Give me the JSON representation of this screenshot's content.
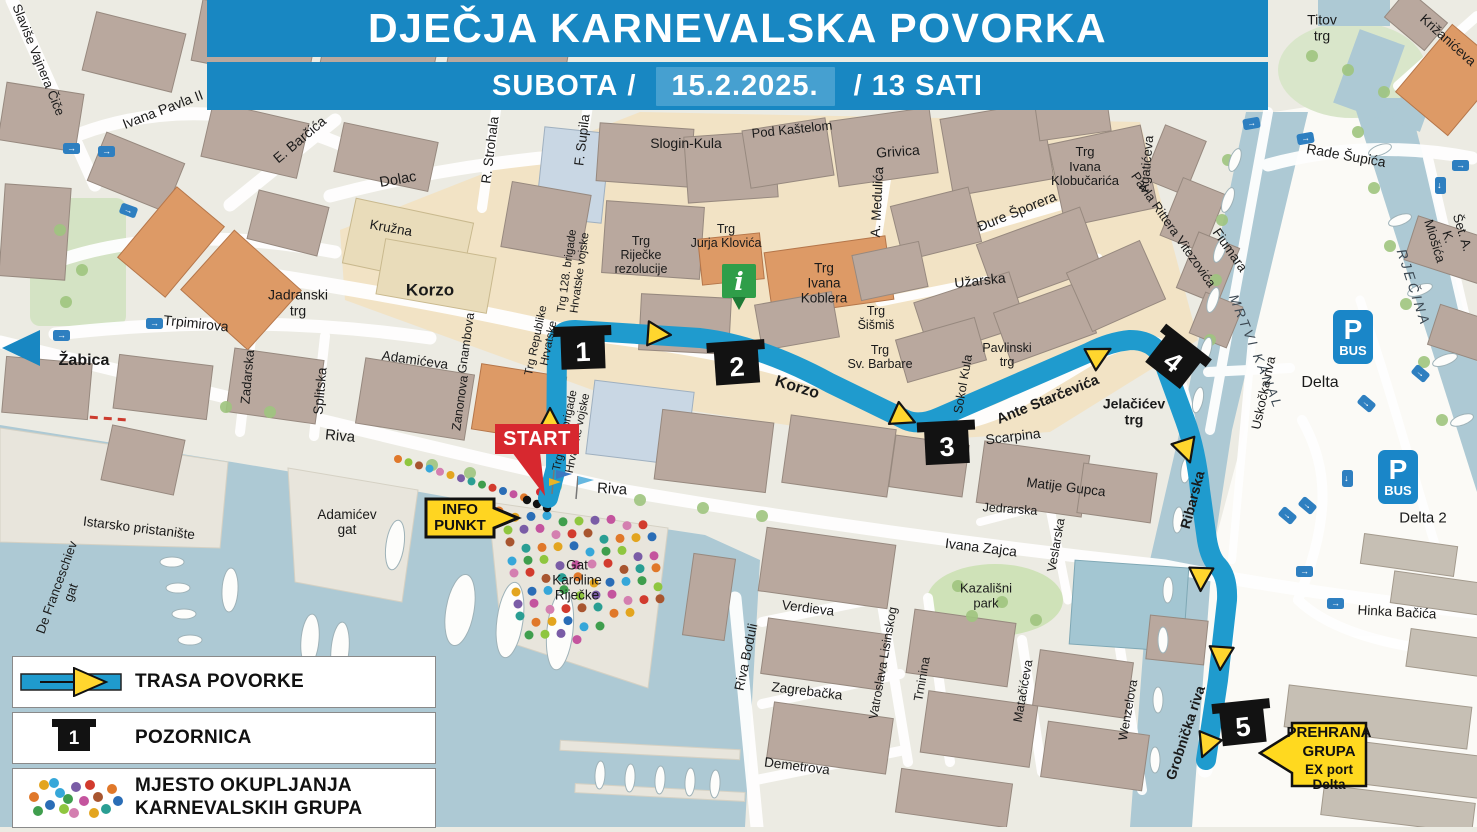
{
  "banner": {
    "title": "DJEČJA KARNEVALSKA POVORKA",
    "day": "SUBOTA",
    "separator1": "/",
    "date": "15.2.2025.",
    "separator2": "/",
    "time": "13 SATI"
  },
  "markers": {
    "start_label": "START",
    "info_punkt_line1": "INFO",
    "info_punkt_line2": "PUNKT",
    "info_icon": "i",
    "stages": [
      "1",
      "2",
      "3",
      "4",
      "5"
    ],
    "prehrana": {
      "line1": "PREHRANA",
      "line2": "GRUPA",
      "line3": "EX port Delta"
    }
  },
  "parking": {
    "p": "P",
    "bus": "BUS",
    "delta": "Delta",
    "delta2": "Delta 2"
  },
  "icons": {
    "one_way": "→"
  },
  "legend": {
    "items": [
      {
        "icon": "route-arrow",
        "label": "TRASA POVORKE"
      },
      {
        "icon": "stage-marker",
        "label": "POZORNICA"
      },
      {
        "icon": "colored-dots",
        "label": "MJESTO OKUPLJANJA KARNEVALSKIH GRUPA",
        "label_line1": "MJESTO OKUPLJANJA",
        "label_line2": "KARNEVALSKIH GRUPA"
      }
    ]
  },
  "colors": {
    "banner_blue": "#1887c2",
    "date_box_blue": "#46a0d0",
    "route_blue": "#1f9bce",
    "arrow_yellow": "#ffd62e",
    "stage_black": "#121212",
    "start_red": "#d7282f",
    "info_yellow": "#ffd521",
    "info_green": "#2f9e49",
    "pbus_blue": "#1a86c8",
    "water": "#adc9d4",
    "old_town_tan": "#f2e2c2",
    "building": "#b9a89e"
  },
  "map_labels": [
    {
      "t": "Slaviše Vajnera Čiče",
      "x": 38,
      "y": 60,
      "r": 68,
      "s": 13
    },
    {
      "t": "Ivana Pavla II",
      "x": 163,
      "y": 110,
      "r": -21,
      "s": 14
    },
    {
      "t": "E. Barčića",
      "x": 300,
      "y": 140,
      "r": -40,
      "s": 14
    },
    {
      "t": "Dolac",
      "x": 398,
      "y": 180,
      "r": -10,
      "s": 14.5
    },
    {
      "t": "R. Strohala",
      "x": 490,
      "y": 150,
      "r": -83,
      "s": 13.5
    },
    {
      "t": "F. Supila",
      "x": 582,
      "y": 140,
      "r": -83,
      "s": 13.5
    },
    {
      "t": "Slogin-Kula",
      "x": 686,
      "y": 144,
      "r": 0,
      "s": 14
    },
    {
      "t": "Pod Kaštelom",
      "x": 792,
      "y": 130,
      "r": -6,
      "s": 13
    },
    {
      "t": "Grivica",
      "x": 898,
      "y": 152,
      "r": -4,
      "s": 14
    },
    {
      "t": "A. Medulića",
      "x": 877,
      "y": 202,
      "r": -87,
      "s": 13.5
    },
    {
      "t": "Đure Šporera",
      "x": 1017,
      "y": 212,
      "r": -22,
      "s": 14
    },
    {
      "t": "Trg\nIvana\nKlobučarića",
      "x": 1085,
      "y": 167,
      "r": 0,
      "s": 13
    },
    {
      "t": "Titov\ntrg",
      "x": 1322,
      "y": 28,
      "r": 0,
      "s": 14
    },
    {
      "t": "Križanićeva",
      "x": 1448,
      "y": 40,
      "r": 42,
      "s": 13.5
    },
    {
      "t": "Rade Šupića",
      "x": 1346,
      "y": 156,
      "r": 10,
      "s": 14
    },
    {
      "t": "Šet. A. K. Miošića",
      "x": 1448,
      "y": 237,
      "r": 73,
      "s": 13
    },
    {
      "t": "RJEČINA",
      "x": 1413,
      "y": 288,
      "r": 72,
      "s": 14,
      "it": 1,
      "ls": 3,
      "c": "#3c4852"
    },
    {
      "t": "MRTVI  KANAL",
      "x": 1256,
      "y": 352,
      "r": 68,
      "s": 13.5,
      "it": 1,
      "ls": 3,
      "c": "#3c4852"
    },
    {
      "t": "Fiumara",
      "x": 1230,
      "y": 250,
      "r": 55,
      "s": 13.5
    },
    {
      "t": "Pavla Rittera Vitezovića",
      "x": 1173,
      "y": 230,
      "r": 55,
      "s": 13
    },
    {
      "t": "Agatićeva",
      "x": 1147,
      "y": 164,
      "r": -85,
      "s": 13
    },
    {
      "t": "Kružna",
      "x": 391,
      "y": 228,
      "r": 10,
      "s": 13.5
    },
    {
      "t": "Korzo",
      "x": 430,
      "y": 290,
      "r": 0,
      "s": 17,
      "w": 700
    },
    {
      "t": "Jadranski\ntrg",
      "x": 298,
      "y": 303,
      "r": 0,
      "s": 14
    },
    {
      "t": "Trpimirova",
      "x": 196,
      "y": 324,
      "r": 6,
      "s": 14
    },
    {
      "t": "Žabica",
      "x": 84,
      "y": 361,
      "r": 0,
      "s": 16,
      "w": 700
    },
    {
      "t": "Zadarska",
      "x": 248,
      "y": 377,
      "r": -85,
      "s": 13
    },
    {
      "t": "Splitska",
      "x": 320,
      "y": 391,
      "r": -85,
      "s": 13.5
    },
    {
      "t": "Adamićeva",
      "x": 415,
      "y": 360,
      "r": 8,
      "s": 13.5
    },
    {
      "t": "Gnambova",
      "x": 466,
      "y": 343,
      "r": -82,
      "s": 12.5
    },
    {
      "t": "Zanonova",
      "x": 460,
      "y": 403,
      "r": -82,
      "s": 12.5
    },
    {
      "t": "Trg Republike\nHrvatske",
      "x": 543,
      "y": 342,
      "r": -78,
      "s": 11.5
    },
    {
      "t": "Trg 111. brigade\nHrvatske vojske",
      "x": 572,
      "y": 432,
      "r": -78,
      "s": 11.5
    },
    {
      "t": "Trg 128. brigade\nHrvatske vojske",
      "x": 574,
      "y": 272,
      "r": -82,
      "s": 11.5
    },
    {
      "t": "Trg\nRiječke\nrezolucije",
      "x": 641,
      "y": 255,
      "r": 0,
      "s": 12.5
    },
    {
      "t": "Trg\nJurja Klovića",
      "x": 726,
      "y": 236,
      "r": 0,
      "s": 12.5
    },
    {
      "t": "Trg\nIvana\nKoblera",
      "x": 824,
      "y": 283,
      "r": 0,
      "s": 13.5
    },
    {
      "t": "Trg\nŠišmiš",
      "x": 876,
      "y": 318,
      "r": 0,
      "s": 12.5
    },
    {
      "t": "Trg\nSv. Barbare",
      "x": 880,
      "y": 357,
      "r": 0,
      "s": 12.5
    },
    {
      "t": "Pavlinski\ntrg",
      "x": 1007,
      "y": 355,
      "r": 0,
      "s": 12.5
    },
    {
      "t": "Užarska",
      "x": 980,
      "y": 281,
      "r": -6,
      "s": 14
    },
    {
      "t": "Sokol Kula",
      "x": 963,
      "y": 384,
      "r": -80,
      "s": 12.5
    },
    {
      "t": "Korzo",
      "x": 797,
      "y": 388,
      "r": 17,
      "s": 16,
      "w": 600
    },
    {
      "t": "Ante Starčevića",
      "x": 1048,
      "y": 400,
      "r": -22,
      "s": 14.5,
      "w": 600
    },
    {
      "t": "Scarpina",
      "x": 1013,
      "y": 437,
      "r": -7,
      "s": 14
    },
    {
      "t": "Jelačićev\ntrg",
      "x": 1134,
      "y": 412,
      "r": 0,
      "s": 14,
      "w": 600
    },
    {
      "t": "Matije Gupca",
      "x": 1066,
      "y": 487,
      "r": 7,
      "s": 13.5
    },
    {
      "t": "Jedrarska",
      "x": 1010,
      "y": 509,
      "r": 4,
      "s": 12.5
    },
    {
      "t": "Veslarska",
      "x": 1056,
      "y": 545,
      "r": -80,
      "s": 12.5
    },
    {
      "t": "Ribarska",
      "x": 1193,
      "y": 500,
      "r": -75,
      "s": 14,
      "w": 600
    },
    {
      "t": "Uskočka  riva",
      "x": 1264,
      "y": 393,
      "r": -78,
      "s": 13
    },
    {
      "t": "Delta",
      "x": 1320,
      "y": 383,
      "r": 0,
      "s": 16
    },
    {
      "t": "Delta 2",
      "x": 1423,
      "y": 519,
      "r": 0,
      "s": 15
    },
    {
      "t": "Riva",
      "x": 340,
      "y": 437,
      "r": 5,
      "s": 15
    },
    {
      "t": "Riva",
      "x": 612,
      "y": 490,
      "r": 3,
      "s": 15
    },
    {
      "t": "Istarsko pristanište",
      "x": 139,
      "y": 528,
      "r": 7,
      "s": 13.5
    },
    {
      "t": "De Franceschiev\ngat",
      "x": 64,
      "y": 590,
      "r": -70,
      "s": 13
    },
    {
      "t": "Adamićev\ngat",
      "x": 347,
      "y": 522,
      "r": 0,
      "s": 13.5
    },
    {
      "t": "Gat\nKaroline\nRiječke",
      "x": 577,
      "y": 580,
      "r": 0,
      "s": 13.5
    },
    {
      "t": "Ivana Zajca",
      "x": 981,
      "y": 548,
      "r": 7,
      "s": 14
    },
    {
      "t": "Kazališni\npark",
      "x": 986,
      "y": 596,
      "r": 0,
      "s": 13
    },
    {
      "t": "Verdieva",
      "x": 808,
      "y": 608,
      "r": 7,
      "s": 13.5
    },
    {
      "t": "Riva Boduli",
      "x": 746,
      "y": 657,
      "r": -78,
      "s": 13.5
    },
    {
      "t": "Zagrebačka",
      "x": 807,
      "y": 691,
      "r": 7,
      "s": 13.5
    },
    {
      "t": "Vatroslava Lisinskog",
      "x": 883,
      "y": 663,
      "r": -80,
      "s": 12.5
    },
    {
      "t": "Trninina",
      "x": 922,
      "y": 679,
      "r": -80,
      "s": 12.5
    },
    {
      "t": "Matačićeva",
      "x": 1023,
      "y": 691,
      "r": -80,
      "s": 12.5
    },
    {
      "t": "Wenzelova",
      "x": 1128,
      "y": 710,
      "r": -80,
      "s": 12.5
    },
    {
      "t": "Demetrova",
      "x": 797,
      "y": 766,
      "r": 7,
      "s": 13.5
    },
    {
      "t": "Grobnička  riva",
      "x": 1186,
      "y": 733,
      "r": -72,
      "s": 14,
      "w": 600
    },
    {
      "t": "Hinka Bačića",
      "x": 1397,
      "y": 612,
      "r": 3,
      "s": 13.5
    }
  ]
}
